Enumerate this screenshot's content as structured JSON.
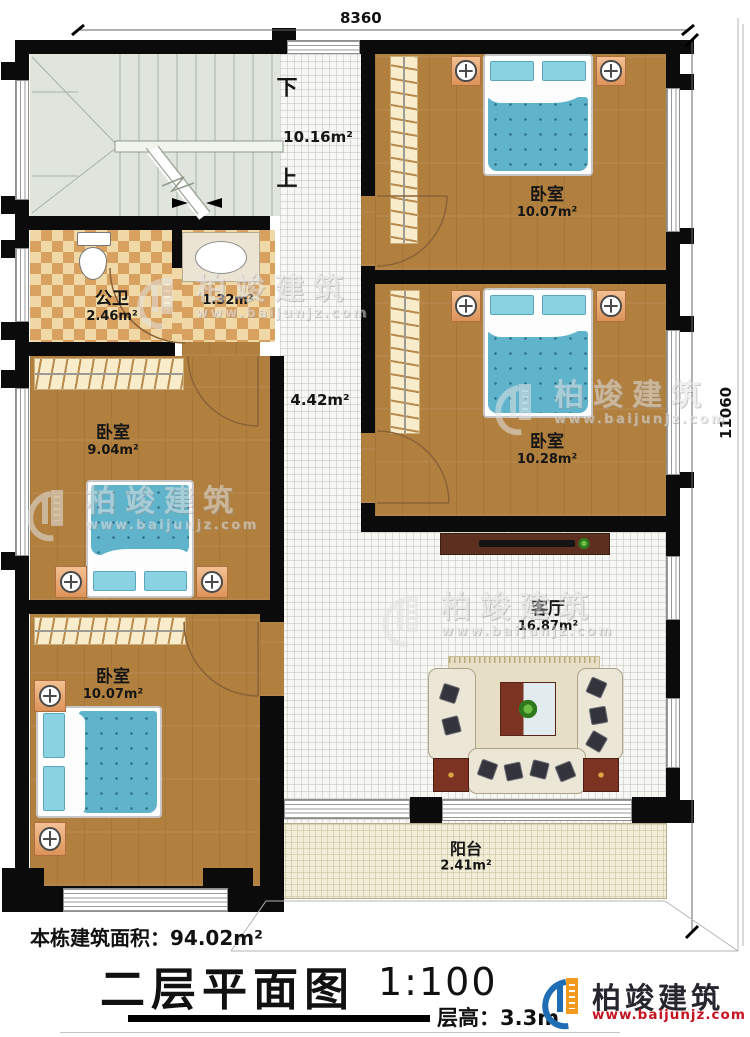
{
  "dimensions": {
    "top": "8360",
    "right": "11060"
  },
  "stairs": {
    "down": "下",
    "up": "上",
    "area": "10.16m²"
  },
  "hall": {
    "area": "4.42m²"
  },
  "rooms": {
    "bathroom": {
      "name": "公卫",
      "area": "2.46m²"
    },
    "wash": {
      "area": "1.32m²"
    },
    "bedroom_tr": {
      "name": "卧室",
      "area": "10.07m²"
    },
    "bedroom_mr": {
      "name": "卧室",
      "area": "10.28m²"
    },
    "bedroom_ml": {
      "name": "卧室",
      "area": "9.04m²"
    },
    "bedroom_bl": {
      "name": "卧室",
      "area": "10.07m²"
    },
    "living": {
      "name": "客厅",
      "area": "16.87m²"
    },
    "balcony": {
      "name": "阳台",
      "area": "2.41m²"
    }
  },
  "footer": {
    "building_area": "本栋建筑面积：94.02m²",
    "plan_title": "二层平面图",
    "scale": "1:100",
    "floor_height": "层高：3.3m"
  },
  "brand": {
    "name": "柏竣建筑",
    "website": "www.baijunjz.com"
  },
  "watermark": {
    "name": "柏竣建筑",
    "website": "www.baijunjz.com"
  },
  "colors": {
    "wall": "#0b0b0b",
    "wood": "#b1803f",
    "bed_blue": "#5fb4cc",
    "brand_blue": "#1f6eb5",
    "brand_orange": "#f29a1d",
    "brand_red": "#c51422"
  }
}
